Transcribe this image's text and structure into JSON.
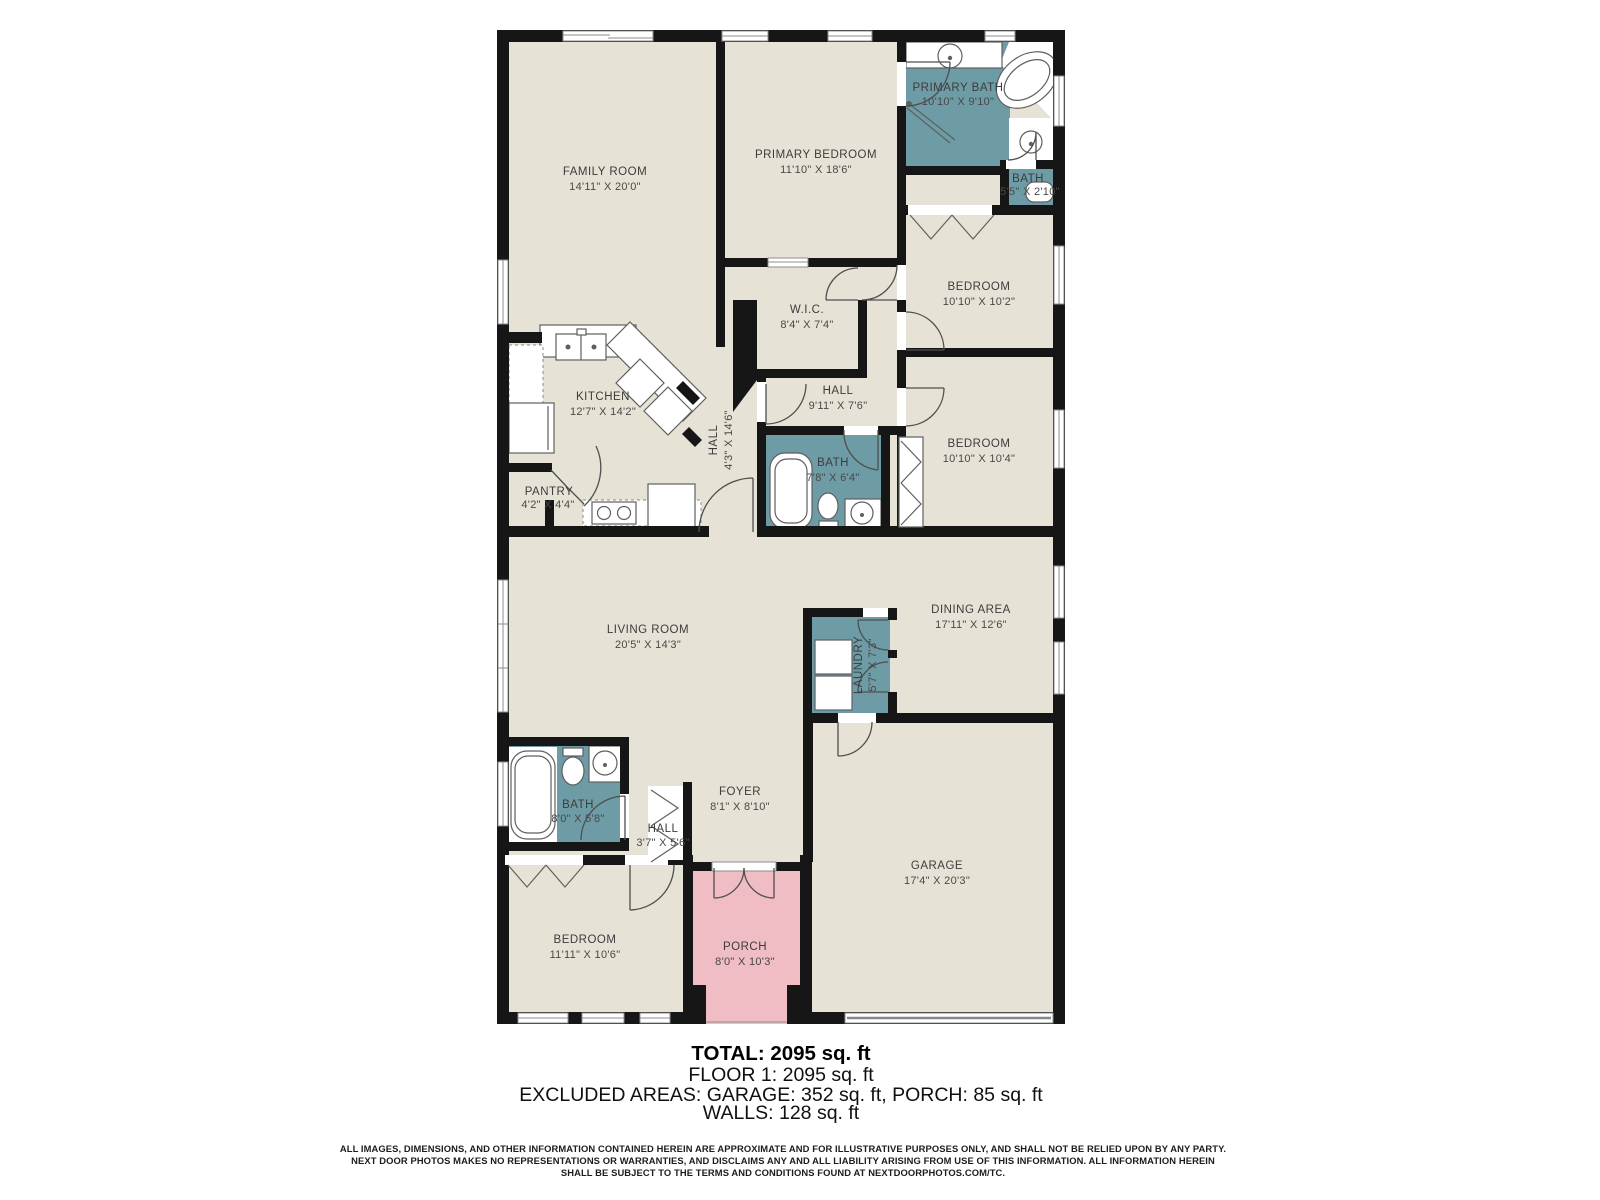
{
  "colors": {
    "floor": "#e6e3d6",
    "wet_room": "#6d9ca6",
    "porch": "#efbdc3",
    "wall": "#161616",
    "background": "#ffffff"
  },
  "rooms": [
    {
      "id": "family-room",
      "name": "FAMILY ROOM",
      "dims": "14'11\" X 20'0\""
    },
    {
      "id": "primary-bedroom",
      "name": "PRIMARY BEDROOM",
      "dims": "11'10\" X 18'6\""
    },
    {
      "id": "primary-bath",
      "name": "PRIMARY BATH",
      "dims": "10'10\" X 9'10\""
    },
    {
      "id": "bath-2",
      "name": "BATH",
      "dims": "5'5\" X 2'10\""
    },
    {
      "id": "bedroom-1",
      "name": "BEDROOM",
      "dims": "10'10\" X 10'2\""
    },
    {
      "id": "wic",
      "name": "W.I.C.",
      "dims": "8'4\" X 7'4\""
    },
    {
      "id": "hall-upper",
      "name": "HALL",
      "dims": "9'11\" X 7'6\""
    },
    {
      "id": "bedroom-2",
      "name": "BEDROOM",
      "dims": "10'10\" X 10'4\""
    },
    {
      "id": "bath-3",
      "name": "BATH",
      "dims": "7'8\" X 6'4\""
    },
    {
      "id": "kitchen",
      "name": "KITCHEN",
      "dims": "12'7\" X 14'2\""
    },
    {
      "id": "pantry",
      "name": "PANTRY",
      "dims": "4'2\" X 4'4\""
    },
    {
      "id": "hall-vertical",
      "name": "HALL",
      "dims": "4'3\" X 14'6\""
    },
    {
      "id": "living-room",
      "name": "LIVING ROOM",
      "dims": "20'5\" X 14'3\""
    },
    {
      "id": "dining-area",
      "name": "DINING AREA",
      "dims": "17'11\" X 12'6\""
    },
    {
      "id": "laundry",
      "name": "LAUNDRY",
      "dims": "5'7\" X 7'3\""
    },
    {
      "id": "bath-main",
      "name": "BATH",
      "dims": "8'0\" X 5'8\""
    },
    {
      "id": "hall-lower",
      "name": "HALL",
      "dims": "3'7\" X 5'6\""
    },
    {
      "id": "foyer",
      "name": "FOYER",
      "dims": "8'1\" X 8'10\""
    },
    {
      "id": "bedroom-3",
      "name": "BEDROOM",
      "dims": "11'11\" X 10'6\""
    },
    {
      "id": "porch",
      "name": "PORCH",
      "dims": "8'0\" X 10'3\""
    },
    {
      "id": "garage",
      "name": "GARAGE",
      "dims": "17'4\" X 20'3\""
    }
  ],
  "summary": {
    "total": "TOTAL: 2095 sq. ft",
    "floor": "FLOOR 1: 2095 sq. ft",
    "excluded": "EXCLUDED AREAS: GARAGE: 352 sq. ft, PORCH: 85 sq. ft",
    "walls": "WALLS: 128 sq. ft"
  },
  "disclaimer": {
    "line1": "ALL IMAGES, DIMENSIONS, AND OTHER INFORMATION CONTAINED HEREIN ARE APPROXIMATE AND FOR ILLUSTRATIVE PURPOSES ONLY, AND SHALL NOT BE RELIED UPON BY ANY PARTY.",
    "line2": "NEXT DOOR PHOTOS MAKES NO REPRESENTATIONS OR WARRANTIES, AND DISCLAIMS ANY AND ALL LIABILITY ARISING FROM USE OF THIS INFORMATION. ALL INFORMATION HEREIN",
    "line3": "SHALL BE SUBJECT TO THE TERMS AND CONDITIONS FOUND AT NEXTDOORPHOTOS.COM/TC."
  }
}
